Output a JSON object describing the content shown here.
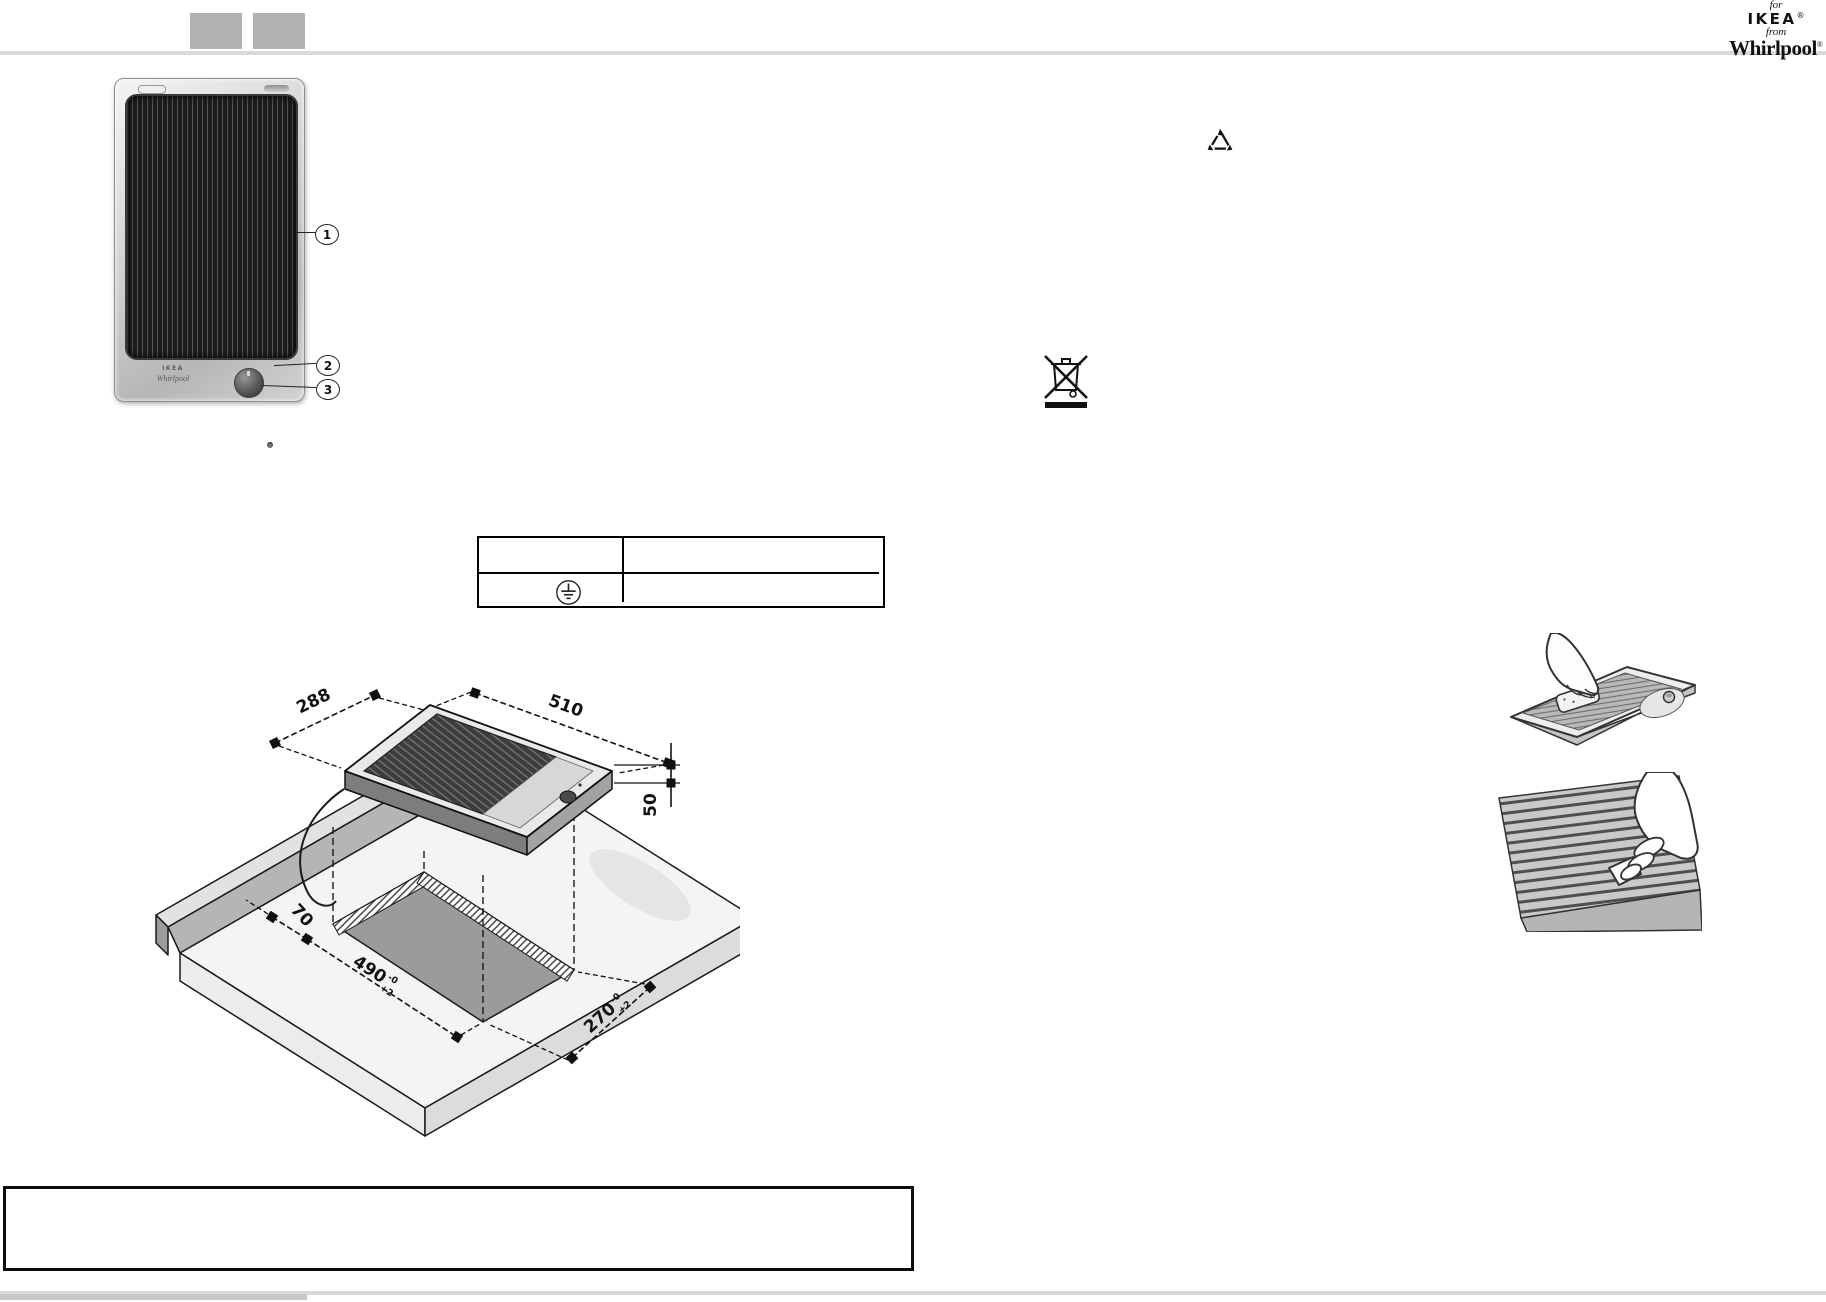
{
  "header": {
    "square_count": 2,
    "logo": {
      "for": "for",
      "brand1": "IKEA",
      "from": "from",
      "brand2": "Whirlpool",
      "registered": "®"
    }
  },
  "product_figure": {
    "brand_small": "IKEA",
    "brand_script": "Whirlpool",
    "callout_1": "1",
    "callout_2": "2",
    "callout_3": "3"
  },
  "connection_table": {
    "ground_symbol": "earth-ground"
  },
  "installation_diagram": {
    "hob_depth": "288",
    "hob_width": "510",
    "hob_height": "50",
    "rear_clearance": "70",
    "cutout_length": "490",
    "cutout_length_tol_top": "-0",
    "cutout_length_tol_bottom": "+2",
    "cutout_width": "270",
    "cutout_width_tol_top": "-0",
    "cutout_width_tol_bottom": "+2"
  },
  "symbols": {
    "recycle": "recycling-triangle",
    "weee": "crossed-out-wheeled-bin-with-bar"
  },
  "note_box": {
    "content": ""
  },
  "colors": {
    "nav_square": "#b2b2b2",
    "rule": "#d9d9d9",
    "ink": "#111111",
    "grill_dark": "#2a2a2a",
    "steel_light": "#e9e9e9",
    "cutout_gray": "#9b9b9b"
  }
}
